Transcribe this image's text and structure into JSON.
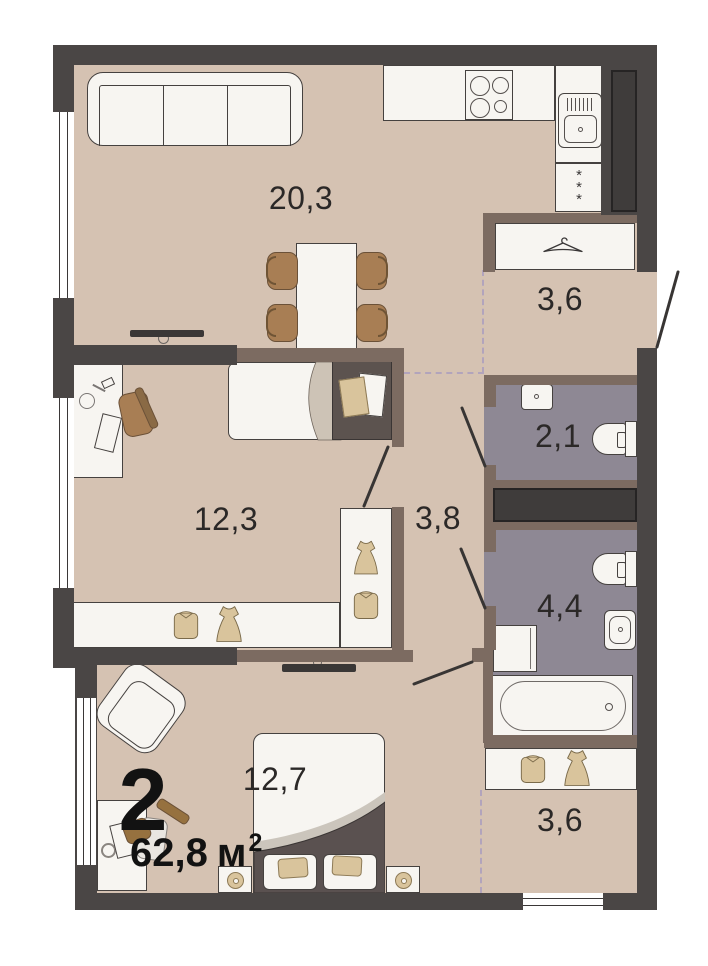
{
  "plan_title": {
    "rooms_count": "2",
    "area_value": "62,8",
    "area_unit": "м",
    "area_superscript": "2"
  },
  "rooms": [
    {
      "name": "living-kitchen",
      "area": "20,3"
    },
    {
      "name": "entry-hall",
      "area": "3,6"
    },
    {
      "name": "wc",
      "area": "2,1"
    },
    {
      "name": "corridor",
      "area": "3,8"
    },
    {
      "name": "bedroom-2",
      "area": "12,3"
    },
    {
      "name": "bathroom",
      "area": "4,4"
    },
    {
      "name": "bedroom-1",
      "area": "12,7"
    },
    {
      "name": "wardrobe-hall",
      "area": "3,6"
    }
  ],
  "icons": {
    "fridge_snowflake": "*"
  },
  "colors": {
    "wall_dark": "#4a4645",
    "wall_brown": "#7c6b61",
    "floor_beige": "#d5c2b2",
    "floor_wet": "#8e8894",
    "furniture_white": "#f7f5f1",
    "wood_brown": "#a87e54",
    "textile_tan": "#d9c49c",
    "label_text": "#2b2827",
    "zone_dashed": "#b2a4bc"
  }
}
